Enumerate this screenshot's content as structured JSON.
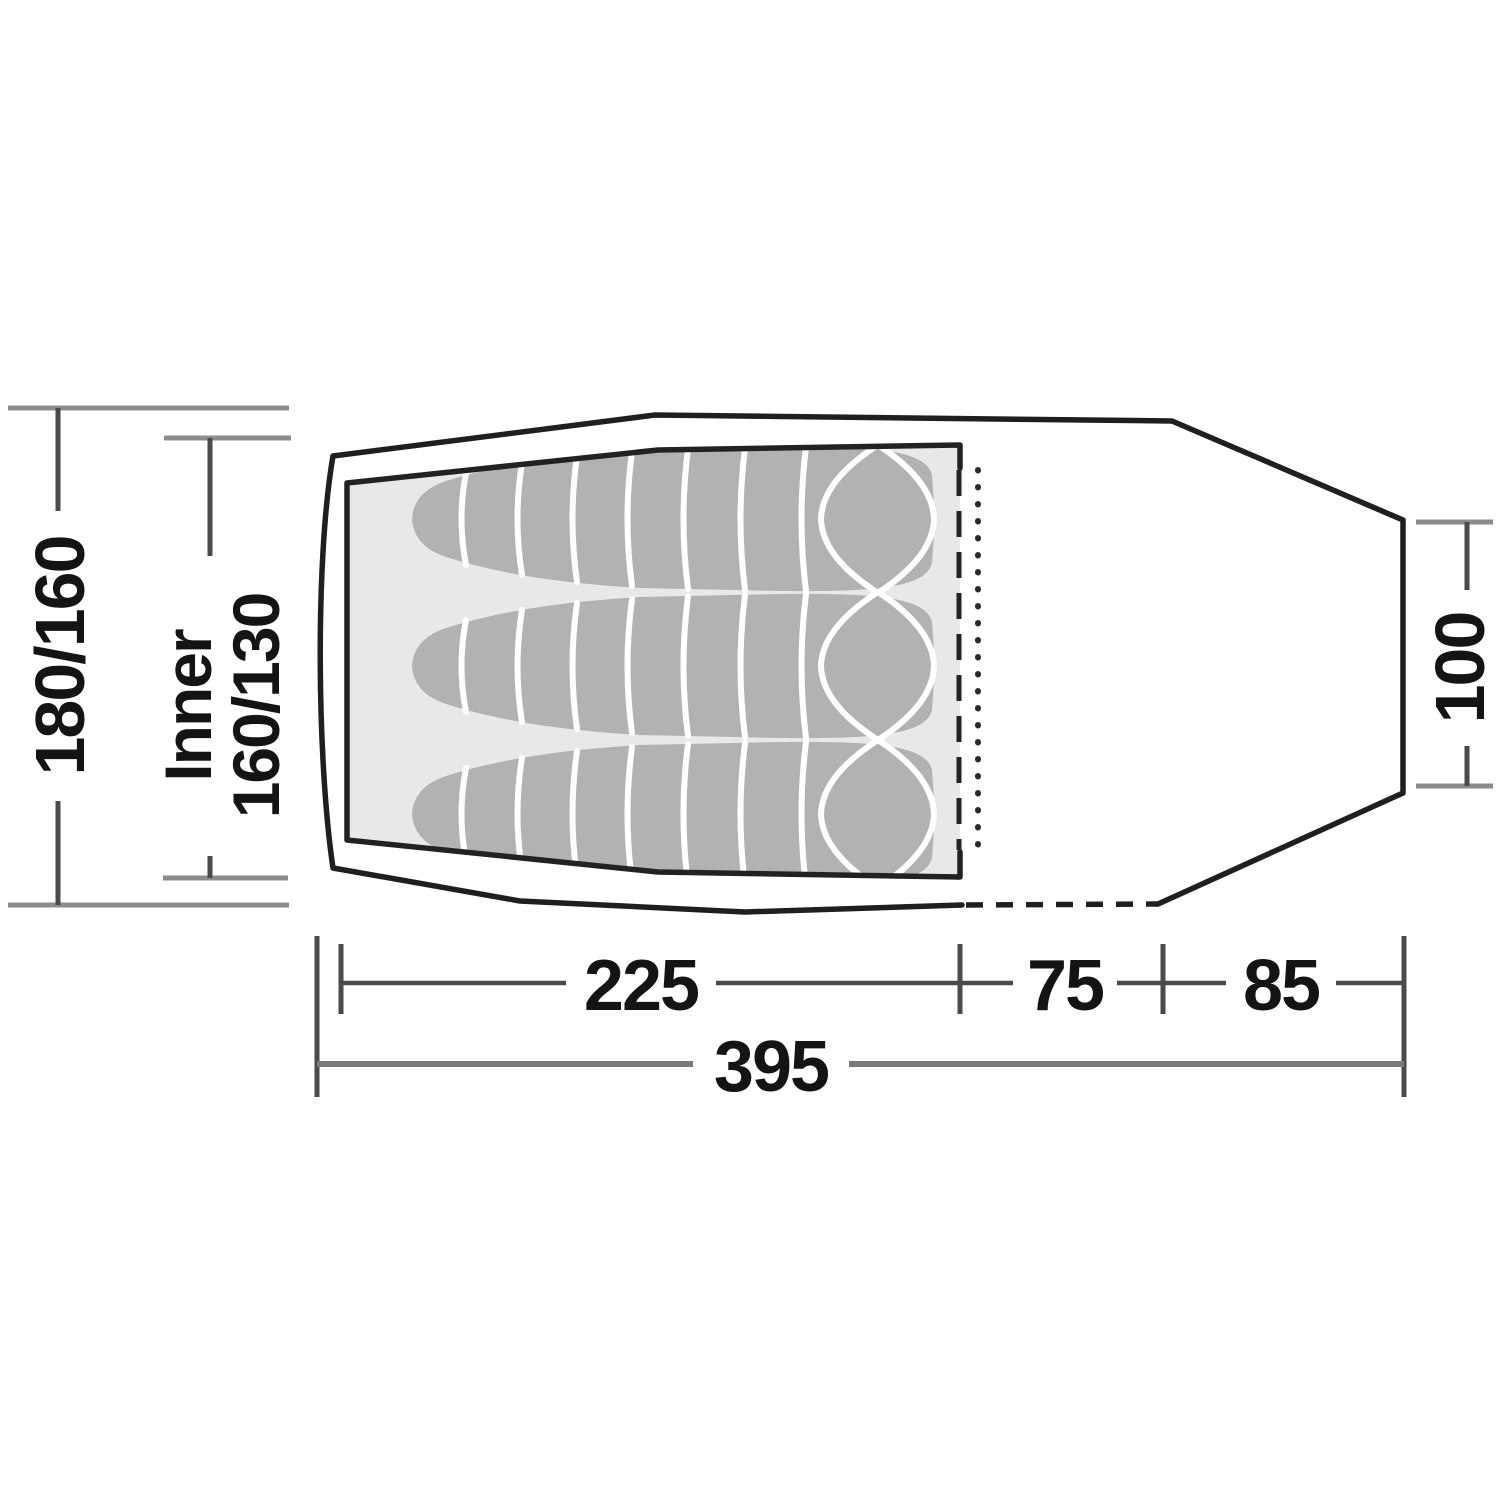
{
  "diagram": {
    "type": "tent-floorplan-top-view",
    "dimensions": {
      "outer_width": "180/160",
      "inner_label": "Inner",
      "inner_width": "160/130",
      "porch_height": "100",
      "inner_length": "225",
      "door_length": "75",
      "porch_length": "85",
      "total_length": "395"
    },
    "elements": {
      "sleeping_bag_count": 3
    },
    "colors": {
      "background": "#ffffff",
      "outline": "#1f1f1f",
      "inner_floor": "#e8e8e8",
      "sleeping_bag": "#b2b2b2",
      "bag_seam": "#ffffff",
      "side_tick": "#8c8c8c",
      "dimension_line": "#4a4a4a",
      "total_line": "#7a7a7a",
      "label_text": "#141414"
    }
  }
}
